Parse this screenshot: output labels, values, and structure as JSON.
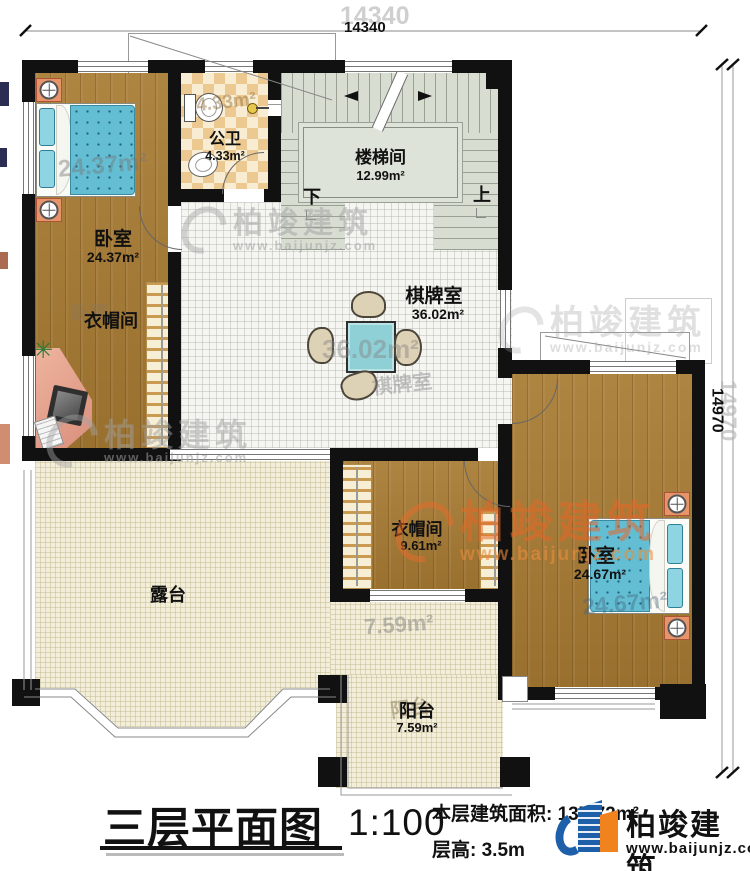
{
  "rooms": {
    "bedroom_left": {
      "name": "卧室",
      "area": "24.37m²"
    },
    "bathroom": {
      "name": "公卫",
      "area": "4.33m²"
    },
    "stairwell": {
      "name": "楼梯间",
      "area": "12.99m²"
    },
    "game_room": {
      "name": "棋牌室",
      "area": "36.02m²"
    },
    "cloakroom_left": {
      "name": "衣帽间"
    },
    "terrace": {
      "name": "露台"
    },
    "cloakroom_middle": {
      "name": "衣帽间",
      "area": "9.61m²"
    },
    "bedroom_right": {
      "name": "卧室",
      "area": "24.67m²"
    },
    "balcony": {
      "name": "阳台",
      "area": "7.59m²"
    }
  },
  "stair_marks": {
    "down": "下",
    "up": "上"
  },
  "dimensions": {
    "top": "14340",
    "right": "14970"
  },
  "echoes": {
    "bedroom_left_area": "24.37m²",
    "bathroom_area": "4.33m²",
    "game_area": "36.02m²",
    "game_name": "棋牌室",
    "cloakroom_left_ghost": "卧室",
    "bedroom_right_area": "24.67m²",
    "balcony_area": "7.59m²",
    "balcony_name": "阳台",
    "dim_top": "14340",
    "dim_right": "14970"
  },
  "titleblock": {
    "title": "三层平面图",
    "scale": "1:100",
    "area_label": "本层建筑面积:",
    "area_value": "137.72m²",
    "floor_height_label": "层高:",
    "floor_height_value": "3.5m"
  },
  "brand": {
    "name": "柏竣建筑",
    "url": "www.baijunjz.com"
  },
  "watermark": {
    "name": "柏竣建筑",
    "url": "www.baijunjz.com"
  },
  "icons": {
    "plant": "✳"
  },
  "colors": {
    "wall": "#111111",
    "wood": "#a87b33",
    "tile_light": "#f8ecd2",
    "tile_dark": "#ecc990",
    "stair_floor": "#d8ddd2",
    "grid_room": "#f5f5f2",
    "terrace": "#f3eed9",
    "bed": "#63bed4",
    "table": "#8ed0d6",
    "brand_blue": "#1d5fa8",
    "brand_orange": "#f0831e"
  }
}
